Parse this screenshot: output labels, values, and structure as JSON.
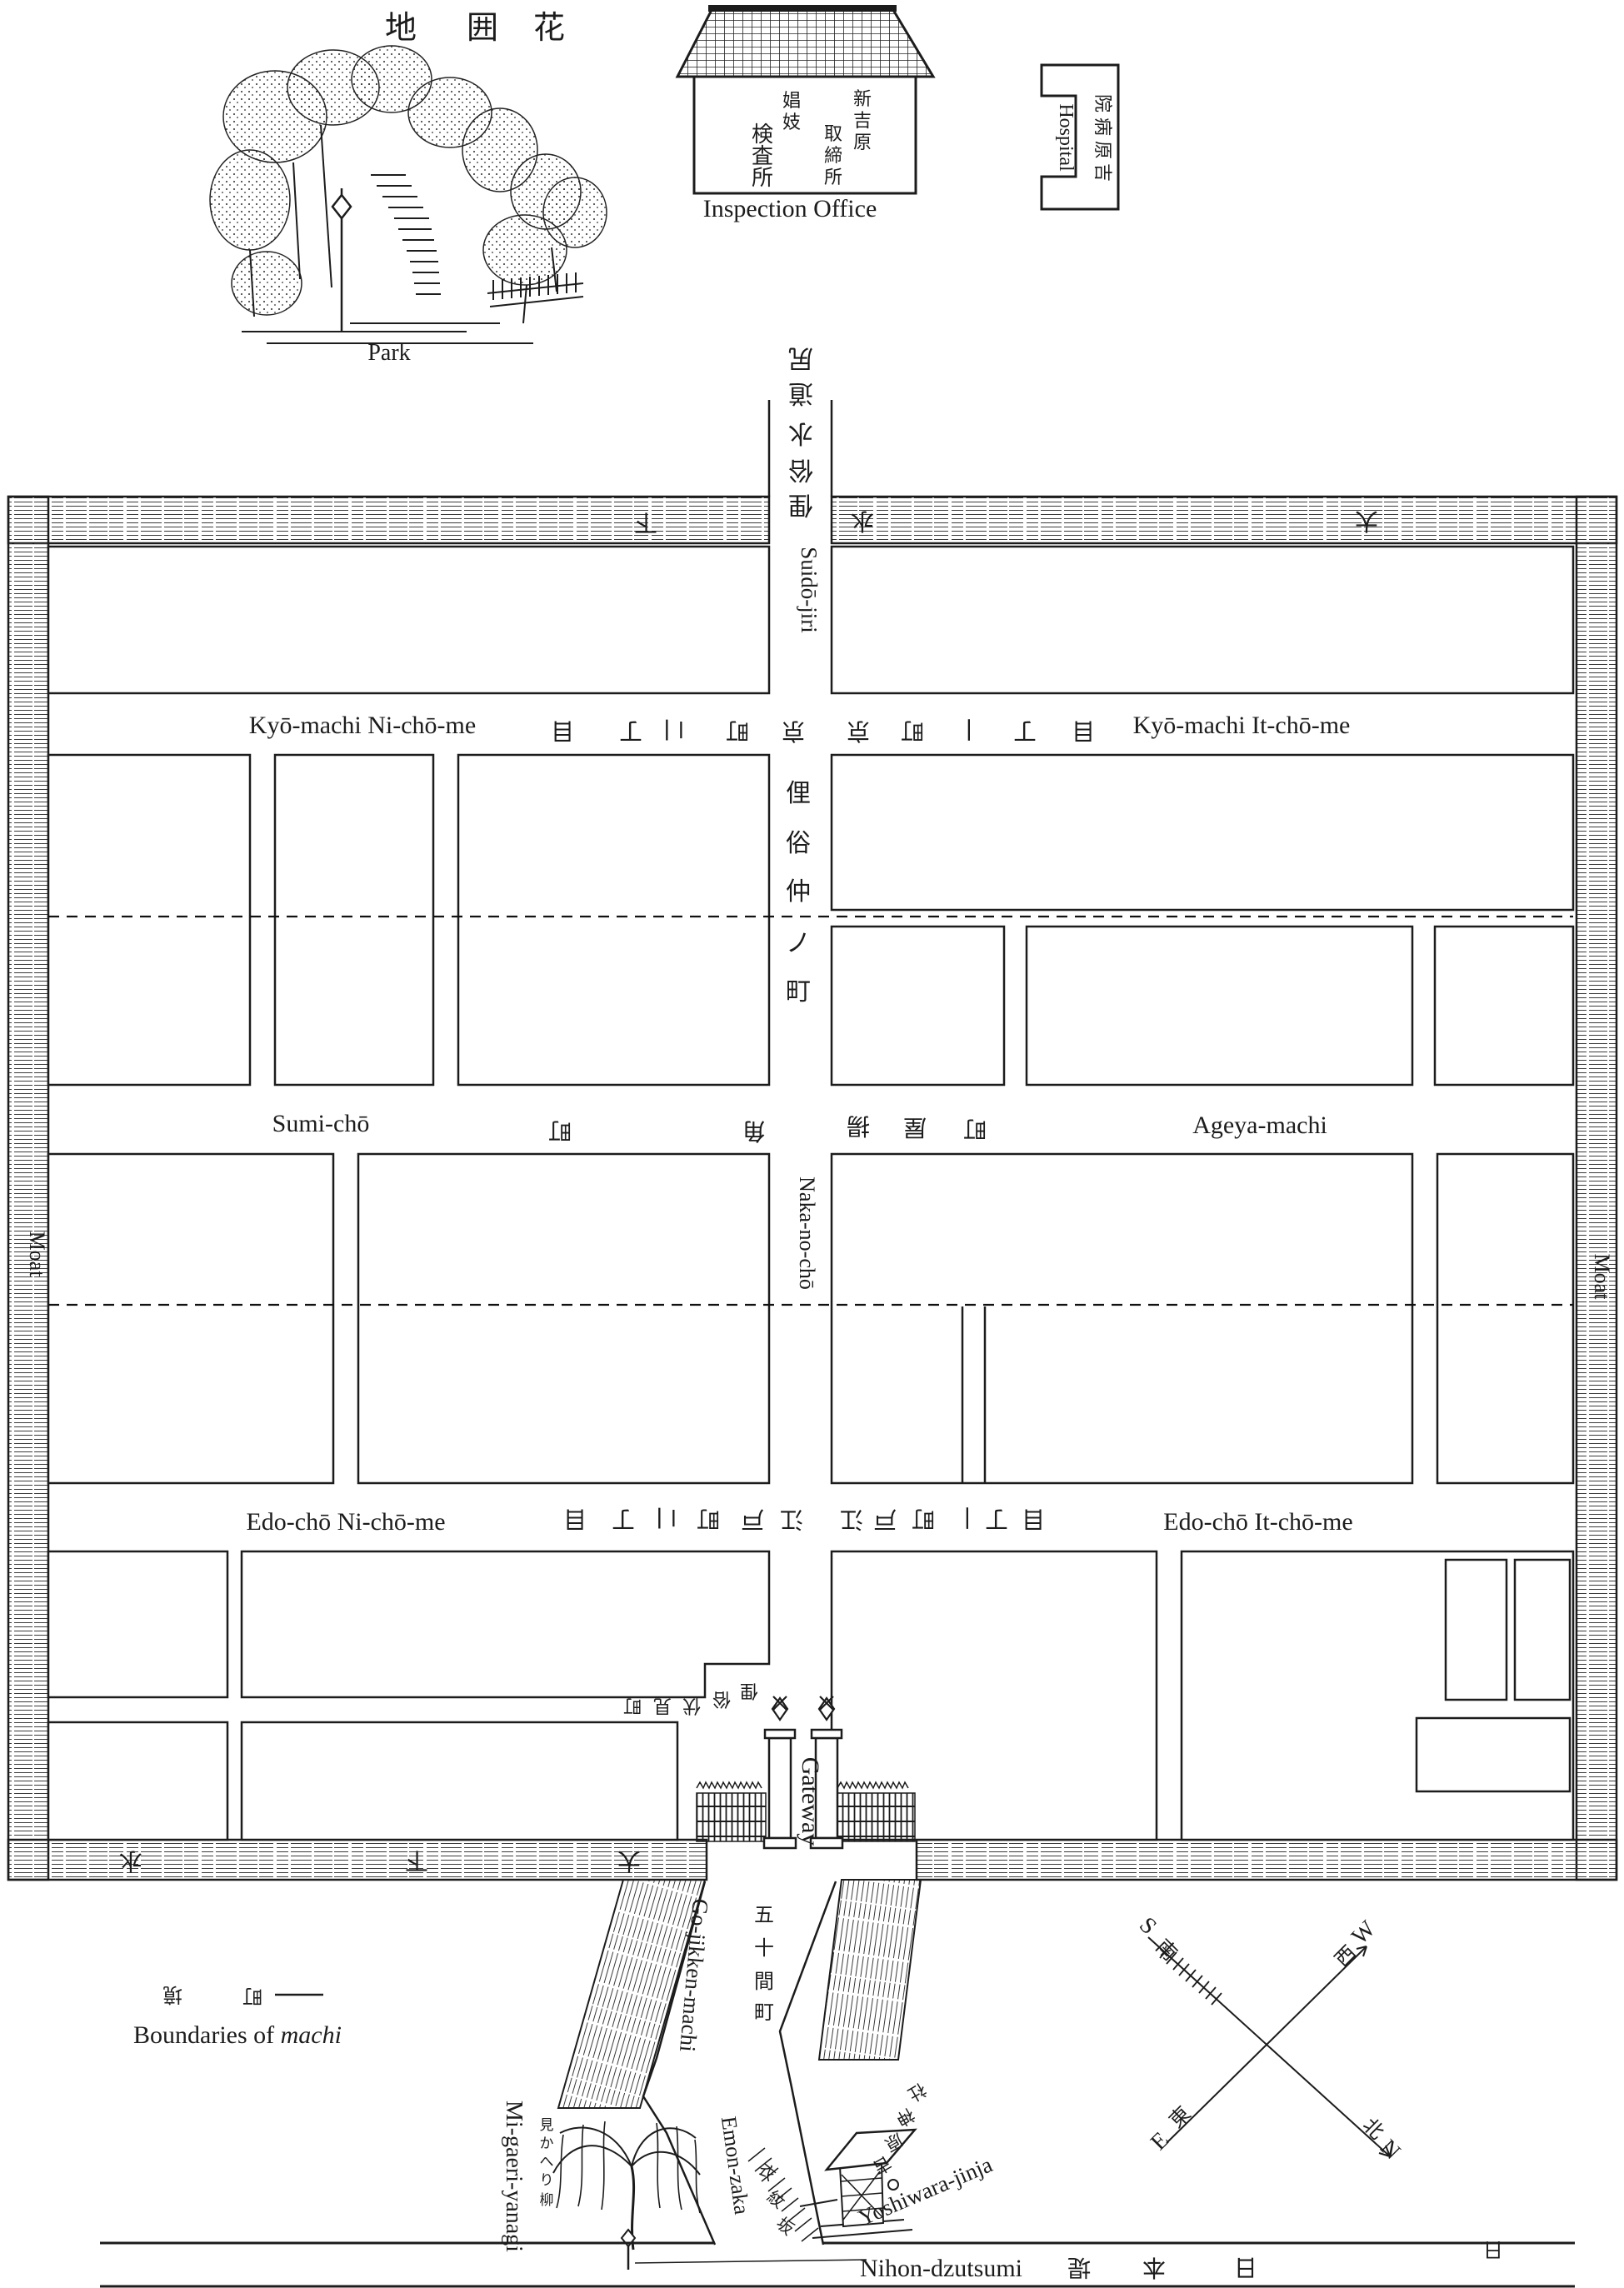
{
  "header": {
    "title_chars": [
      "地",
      "囲",
      "花"
    ],
    "park_label": "Park",
    "inspection_office": {
      "label": "Inspection Office",
      "col_a": [
        "新",
        "吉",
        "原"
      ],
      "col_b": [
        "取",
        "締",
        "所"
      ],
      "col_c": [
        "娼",
        "妓"
      ],
      "col_d": [
        "検",
        "査",
        "所"
      ]
    },
    "hospital": {
      "label": "Hospital",
      "jp_chars": [
        "院",
        "病",
        "原",
        "吉"
      ]
    }
  },
  "map": {
    "moat_label_left": "Moat",
    "moat_label_right": "Moat",
    "top_band_chars": [
      "下",
      "水",
      "大"
    ],
    "bottom_band_chars": [
      "水",
      "下",
      "大"
    ],
    "suidojiri": {
      "romaji": "Suidō-jiri",
      "jp_chars": [
        "尻",
        "道",
        "水",
        "俗",
        "俚"
      ]
    },
    "naka_no_cho": {
      "romaji": "Naka-no-chō",
      "jp_chars": [
        "俚",
        "俗",
        "仲",
        "ノ",
        "町"
      ]
    },
    "kyo_machi_2": {
      "romaji": "Kyō-machi Ni-chō-me",
      "jp_chars": [
        "目",
        "丁",
        "二",
        "町",
        "京"
      ]
    },
    "kyo_machi_1": {
      "romaji": "Kyō-machi It-chō-me",
      "jp_chars": [
        "京",
        "町",
        "一",
        "丁",
        "目"
      ]
    },
    "sumi_cho": {
      "romaji": "Sumi-chō",
      "jp_chars": [
        "町",
        "角"
      ]
    },
    "ageya_machi": {
      "romaji": "Ageya-machi",
      "jp_chars": [
        "揚",
        "屋",
        "町"
      ]
    },
    "edo_cho_2": {
      "romaji": "Edo-chō Ni-chō-me",
      "jp_chars": [
        "目",
        "丁",
        "二",
        "町",
        "戸",
        "江"
      ]
    },
    "edo_cho_1": {
      "romaji": "Edo-chō It-chō-me",
      "jp_chars": [
        "江",
        "戸",
        "町",
        "一",
        "丁",
        "目"
      ]
    },
    "fushimi_cho_chars": [
      "町",
      "見",
      "伏",
      "俗",
      "俚"
    ],
    "gateway_label": "Gateway"
  },
  "outside": {
    "go_jikken_machi": {
      "romaji": "Go-jikken-machi",
      "jp_chars": [
        "五",
        "十",
        "間",
        "町"
      ]
    },
    "emon_zaka": {
      "romaji": "Emon-zaka",
      "jp_chars": [
        "衣",
        "紋",
        "坂"
      ]
    },
    "mi_gaeri_yanagi": {
      "romaji": "Mi-gaeri-yanagi",
      "jp_chars": [
        "見",
        "か",
        "へ",
        "り",
        "柳"
      ]
    },
    "yoshiwara_jinja": {
      "romaji": "Yoshiwara-jinja",
      "jp_chars": [
        "社",
        "神",
        "原",
        "吉"
      ]
    },
    "nihon_dzutsumi": {
      "romaji": "Nihon-dzutsumi",
      "jp_chars": [
        "堤",
        "本",
        "日"
      ],
      "extra_char": "日"
    },
    "legend": {
      "jp_chars": [
        "境",
        "町"
      ],
      "text": "Boundaries of ",
      "text_italic": "machi"
    },
    "compass": {
      "n": "N",
      "s": "S",
      "e": "E",
      "w": "W",
      "jp_n": "北",
      "jp_s": "南",
      "jp_e": "東",
      "jp_w": "西"
    }
  },
  "colors": {
    "ink": "#1c1c1c",
    "paper": "#ffffff"
  }
}
